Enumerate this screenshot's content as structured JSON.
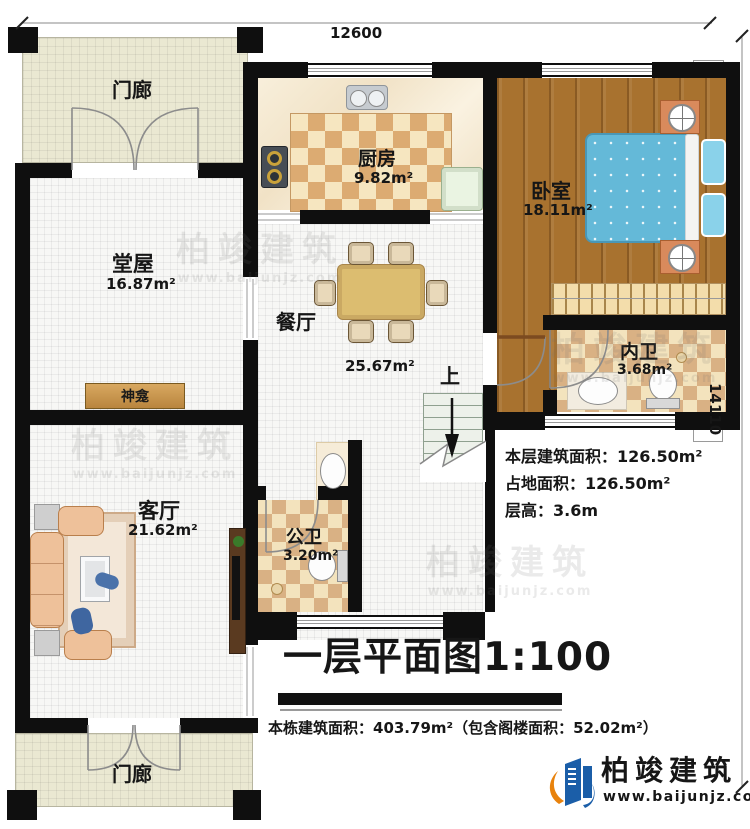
{
  "dimensions": {
    "top": "12600",
    "right": "14110"
  },
  "rooms": {
    "porch_top": {
      "name": "门廊"
    },
    "porch_bottom": {
      "name": "门廊"
    },
    "tangwu": {
      "name": "堂屋",
      "area": "16.87m²"
    },
    "keting": {
      "name": "客厅",
      "area": "21.62m²"
    },
    "canting": {
      "name": "餐厅",
      "area": "25.67m²"
    },
    "chufang": {
      "name": "厨房",
      "area": "9.82m²"
    },
    "woshi": {
      "name": "卧室",
      "area": "18.11m²"
    },
    "neiwei": {
      "name": "内卫",
      "area": "3.68m²"
    },
    "gongwei": {
      "name": "公卫",
      "area": "3.20m²"
    },
    "shenkan": {
      "name": "神龛"
    },
    "stairs": {
      "up_label": "上"
    }
  },
  "stats": {
    "line1": "本层建筑面积：126.50m²",
    "line2": "占地面积：126.50m²",
    "line3": "层高：3.6m"
  },
  "title_block": {
    "title": "一层平面图1:100",
    "total": "本栋建筑面积：403.79m²（包含阁楼面积：52.02m²）"
  },
  "brand": {
    "logo_text": "柏竣建筑",
    "website": "www.baijunjz.com"
  },
  "colors": {
    "wall": "#0f0f0f",
    "wood_floor": "#a8722f",
    "bed_blue": "#64b9d8",
    "checker_tan": "#dcab72",
    "porch": "#eae8d2",
    "brand_blue": "#1b5ea8",
    "brand_orange": "#e8820c"
  }
}
